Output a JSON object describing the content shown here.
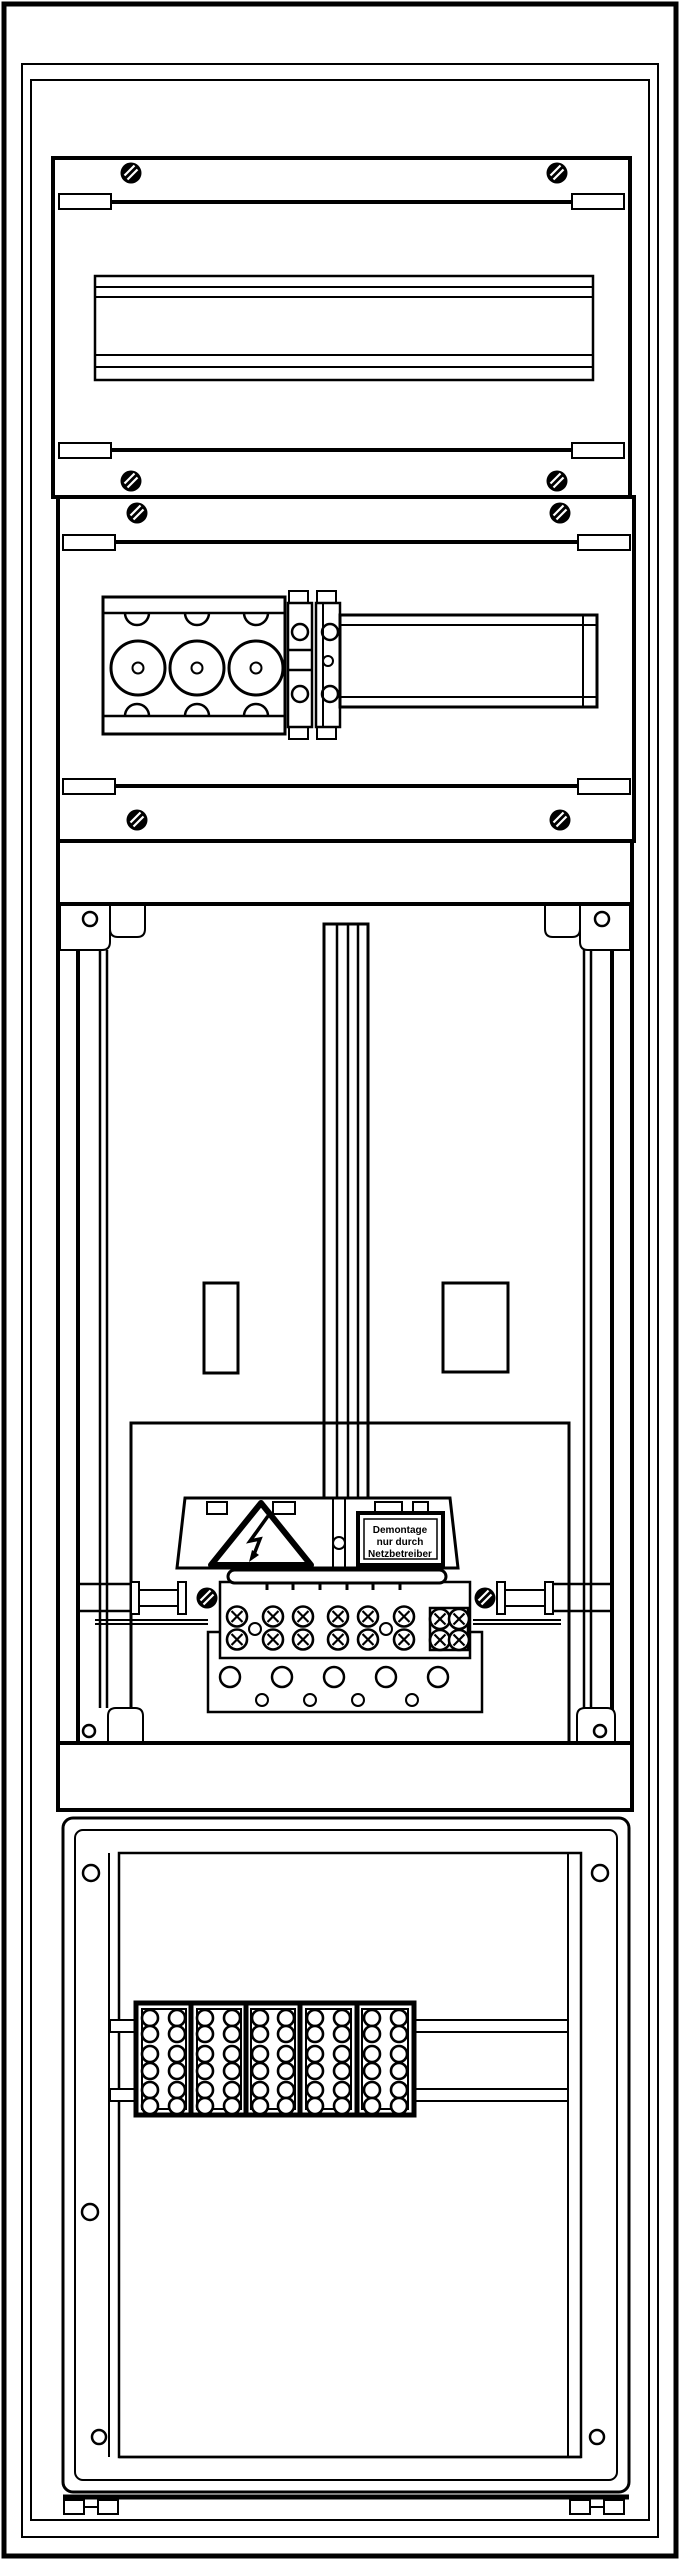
{
  "drawing": {
    "kind": "meter-cabinet-front-view-technical-drawing",
    "background_color": "#ffffff",
    "line_color": "#000000"
  },
  "warning_label": {
    "line1": "Demontage",
    "line2": "nur durch",
    "line3": "Netzbetreiber"
  },
  "inventory": {
    "panel_screws": 8,
    "busbar_screws": 2,
    "din_rails": 2,
    "fuse_holder_circles": 3,
    "terminal_screw_pairs": 6,
    "four_screw_terminal": 1,
    "cable_gland_circles_large": 5,
    "cable_gland_circles_small": 4,
    "bottom_terminal_blocks": 5,
    "holes_per_bottom_block": 12,
    "divider_strips": 4
  }
}
